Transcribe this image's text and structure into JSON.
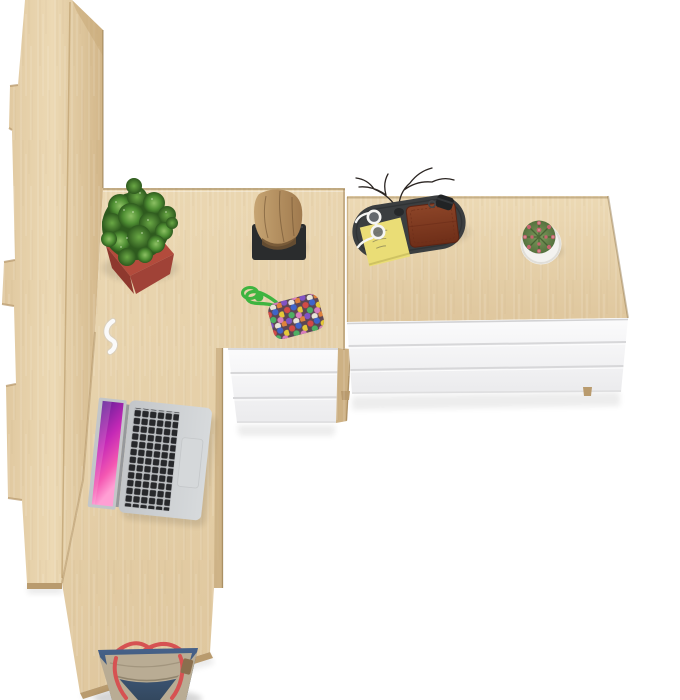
{
  "scene": {
    "description": "Top-down product photo: L-shaped oak desk with built-in white 3-drawer pedestal, matching wide white chest of drawers with oak top, tall oak bookcase at left, open silver laptop, desk accessories, and a denim tote bag on a white floor.",
    "objects": {
      "bookcase": "tall oak bookcase seen from above",
      "desk": "L-shaped oak desk",
      "pedestal": "white 3-drawer desk pedestal",
      "chest": "wide white chest of drawers with oak top",
      "laptop": "open silver laptop with pink abstract wallpaper",
      "plant": "green succulent in red square planter",
      "log": "decorative wooden log on black stand",
      "valet_tray": "dark valet tray holding wallet, sticky notes, glasses, key fob and dry twigs",
      "cactus": "small round cactus in white pot",
      "pouch": "multicolour beaded pouch with bright green cord",
      "cable_clip": "white cable hook on desk edge",
      "bag": "blue denim tote bag with red straps and tan trim"
    },
    "drawer_counts": {
      "pedestal": 3,
      "chest": 3
    }
  },
  "colors": {
    "bg": "#ffffff",
    "oak_light": "#ecd9b4",
    "oak": "#dfc79e",
    "oak_mid": "#d2b689",
    "oak_dark": "#b99b6e",
    "oak_deep": "#8e7347",
    "white_panel": "#fbfbfc",
    "white_panel_low": "#ebebed",
    "panel_gap": "#d7d7d9",
    "stand_black": "#2a2c2d",
    "log_light": "#c6a472",
    "log": "#a07a4e",
    "log_dark": "#6e5232",
    "pot_red": "#b34b3c",
    "pot_red_mid": "#a04237",
    "pot_red_dark": "#8e382e",
    "leaf_light": "#8cc063",
    "leaf_mid": "#6aa845",
    "leaf": "#4f8f33",
    "leaf_dark": "#2e5a1e",
    "tray": "#3b3e40",
    "tray_dark": "#2c2f31",
    "note_yellow": "#eadd76",
    "wallet": "#8d4528",
    "wallet_dark": "#6e2e18",
    "glasses_white": "#f5f5f3",
    "lens": "#686d72",
    "branch": "#2b2522",
    "cactus_light": "#7d9a5c",
    "cactus": "#55713e",
    "cactus_dark": "#3a5629",
    "spine_pink": "#c4656f",
    "cactus_pot": "#f3f2ef",
    "cord_green": "#3eb440",
    "pouch_dark": "#5c4654",
    "beads": [
      "#d24a46",
      "#3f64c9",
      "#e5c838",
      "#4daf63",
      "#d77dbd",
      "#8153c4",
      "#e9e4d8",
      "#e0823c"
    ],
    "laptop_silver": "#d7dadc",
    "laptop_edge": "#c3c6c9",
    "laptop_well": "#bcbfc2",
    "key_black": "#27282b",
    "trackpad": "#d5d8da",
    "hinge": "#97999c",
    "screen_top": "#5f1e96",
    "screen_mid": "#c428b6",
    "screen_pink": "#f457b2",
    "screen_light": "#ff9fd4",
    "denim_light": "#47628a",
    "denim": "#415a7c",
    "denim_dark": "#33485f",
    "bag_tan": "#b9ac94",
    "bag_tan_dark": "#a3967e",
    "strap_red": "#d65252"
  }
}
